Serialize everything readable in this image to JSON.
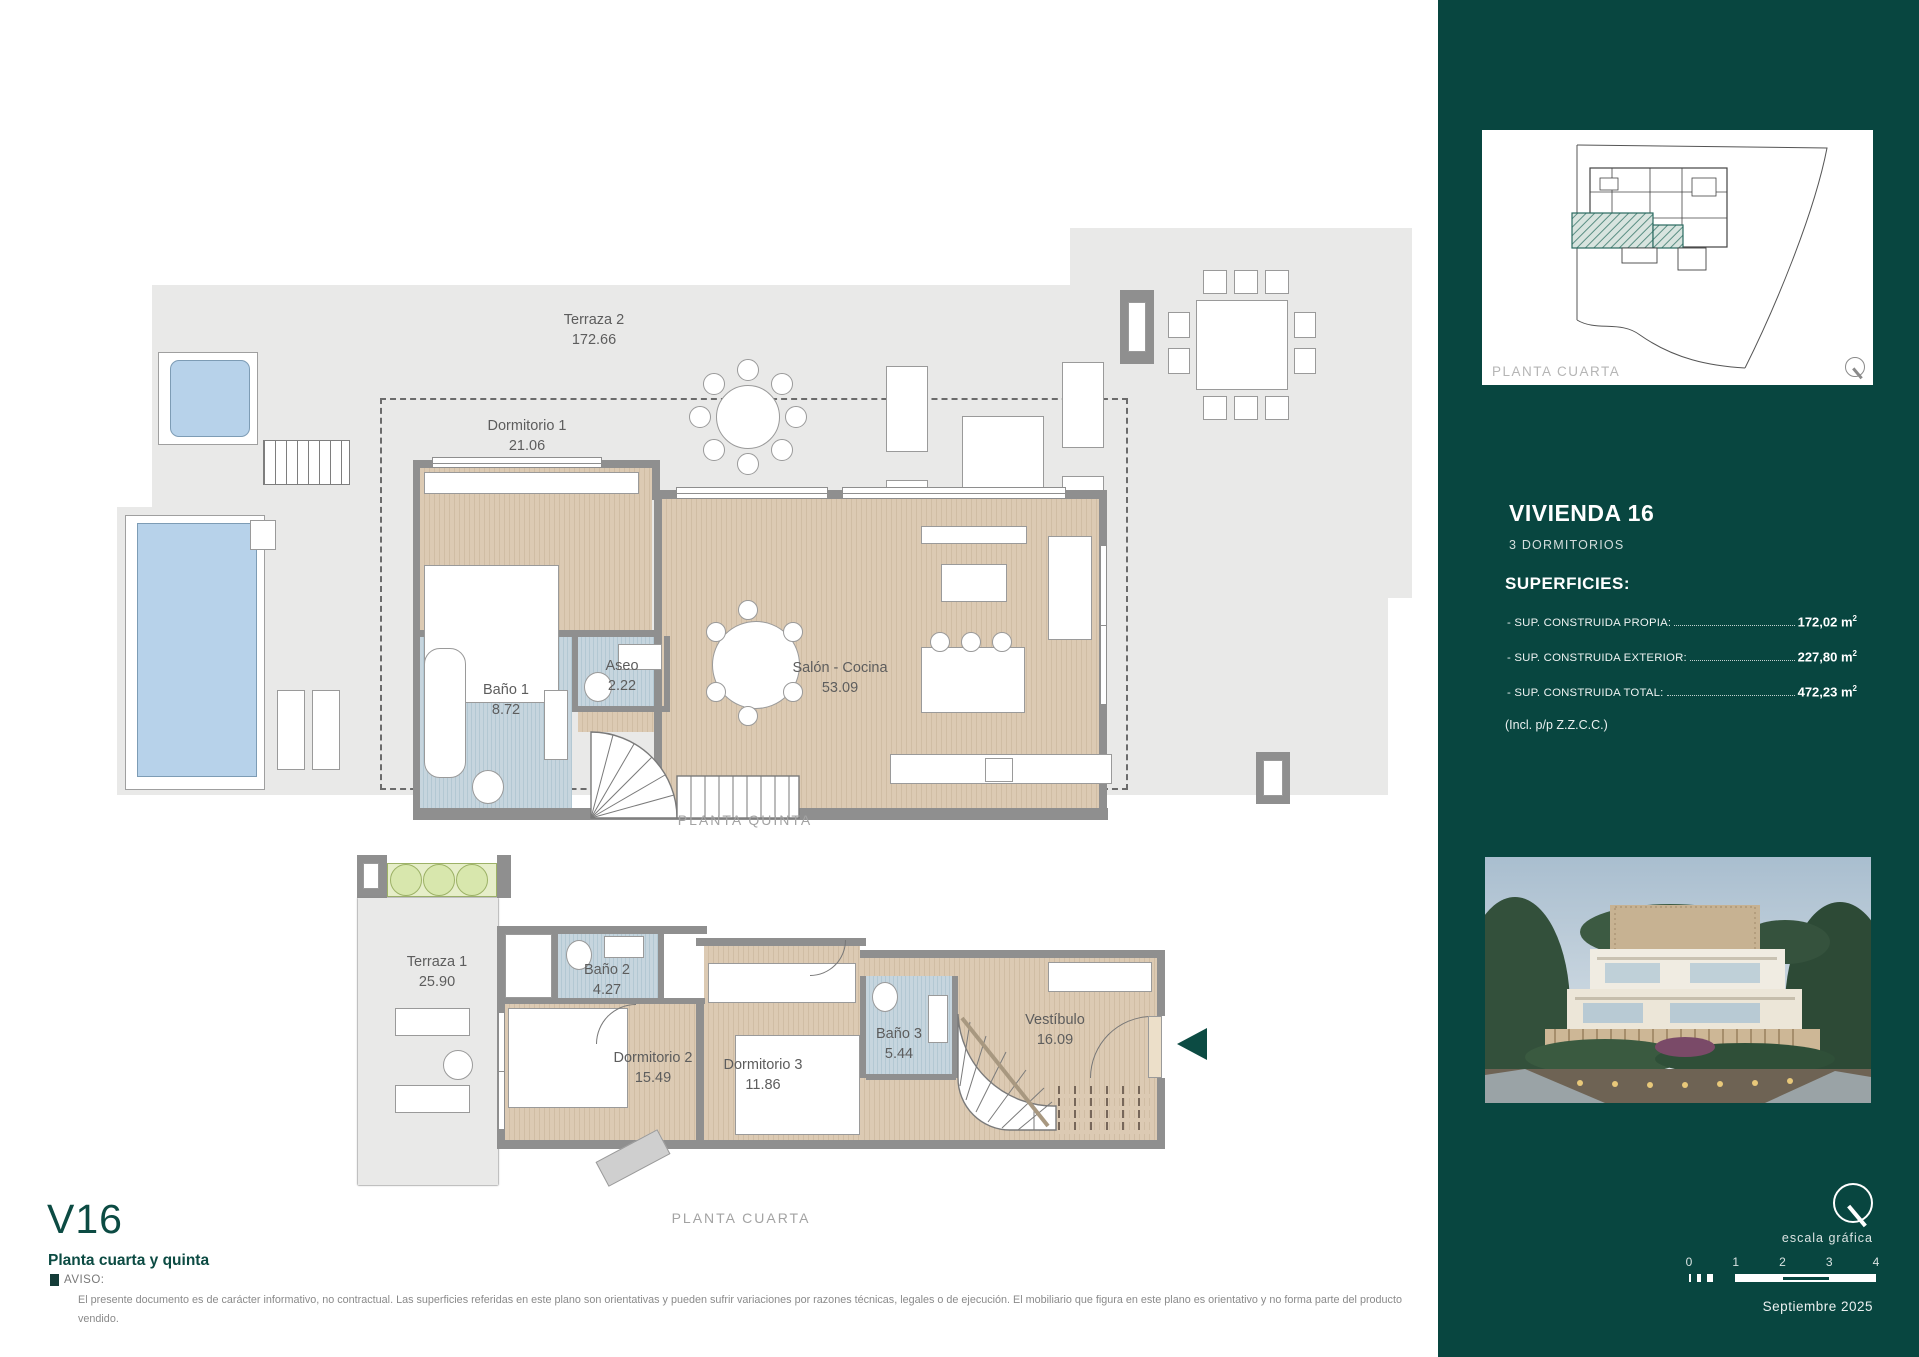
{
  "plan_upper": {
    "caption": "PLANTA QUINTA",
    "rooms": [
      {
        "name": "Terraza 2",
        "area": "172.66"
      },
      {
        "name": "Dormitorio 1",
        "area": "21.06"
      },
      {
        "name": "Baño 1",
        "area": "8.72"
      },
      {
        "name": "Aseo",
        "area": "2.22"
      },
      {
        "name": "Salón - Cocina",
        "area": "53.09"
      }
    ]
  },
  "plan_lower": {
    "caption": "PLANTA CUARTA",
    "rooms": [
      {
        "name": "Terraza 1",
        "area": "25.90"
      },
      {
        "name": "Baño 2",
        "area": "4.27"
      },
      {
        "name": "Dormitorio 2",
        "area": "15.49"
      },
      {
        "name": "Dormitorio 3",
        "area": "11.86"
      },
      {
        "name": "Baño 3",
        "area": "5.44"
      },
      {
        "name": "Vestíbulo",
        "area": "16.09"
      }
    ]
  },
  "title_block": {
    "unit": "V16",
    "subtitle": "Planta cuarta y quinta"
  },
  "notice": {
    "label": "AVISO:",
    "text": "El presente documento es de carácter informativo, no contractual. Las superficies referidas en este plano son orientativas y pueden sufrir variaciones por razones técnicas, legales o de ejecución. El mobiliario que figura en este plano es orientativo y no forma parte del producto vendido."
  },
  "sidebar": {
    "site_plan_caption": "PLANTA CUARTA",
    "unit_title": "VIVIENDA 16",
    "unit_subtitle": "3 DORMITORIOS",
    "surfaces_heading": "SUPERFICIES:",
    "surfaces": [
      {
        "label": "- SUP. CONSTRUIDA PROPIA:",
        "value": "172,02"
      },
      {
        "label": "- SUP. CONSTRUIDA EXTERIOR:",
        "value": "227,80"
      },
      {
        "label": "- SUP. CONSTRUIDA TOTAL:",
        "value": "472,23"
      }
    ],
    "surfaces_unit": "m",
    "surfaces_sup": "2",
    "surfaces_note": "(Incl. p/p Z.Z.C.C.)",
    "scale_label": "escala gráfica",
    "scale_ticks": [
      "0",
      "1",
      "2",
      "3",
      "4"
    ],
    "date": "Septiembre 2025"
  },
  "colors": {
    "panel_green": "#084640",
    "accent_teal": "#0c4b43",
    "pool_blue": "#b7d2ea",
    "wood": "#d8c6ae",
    "tile_blue": "#bfcfda",
    "terrace_gray": "#e9e9e8"
  }
}
